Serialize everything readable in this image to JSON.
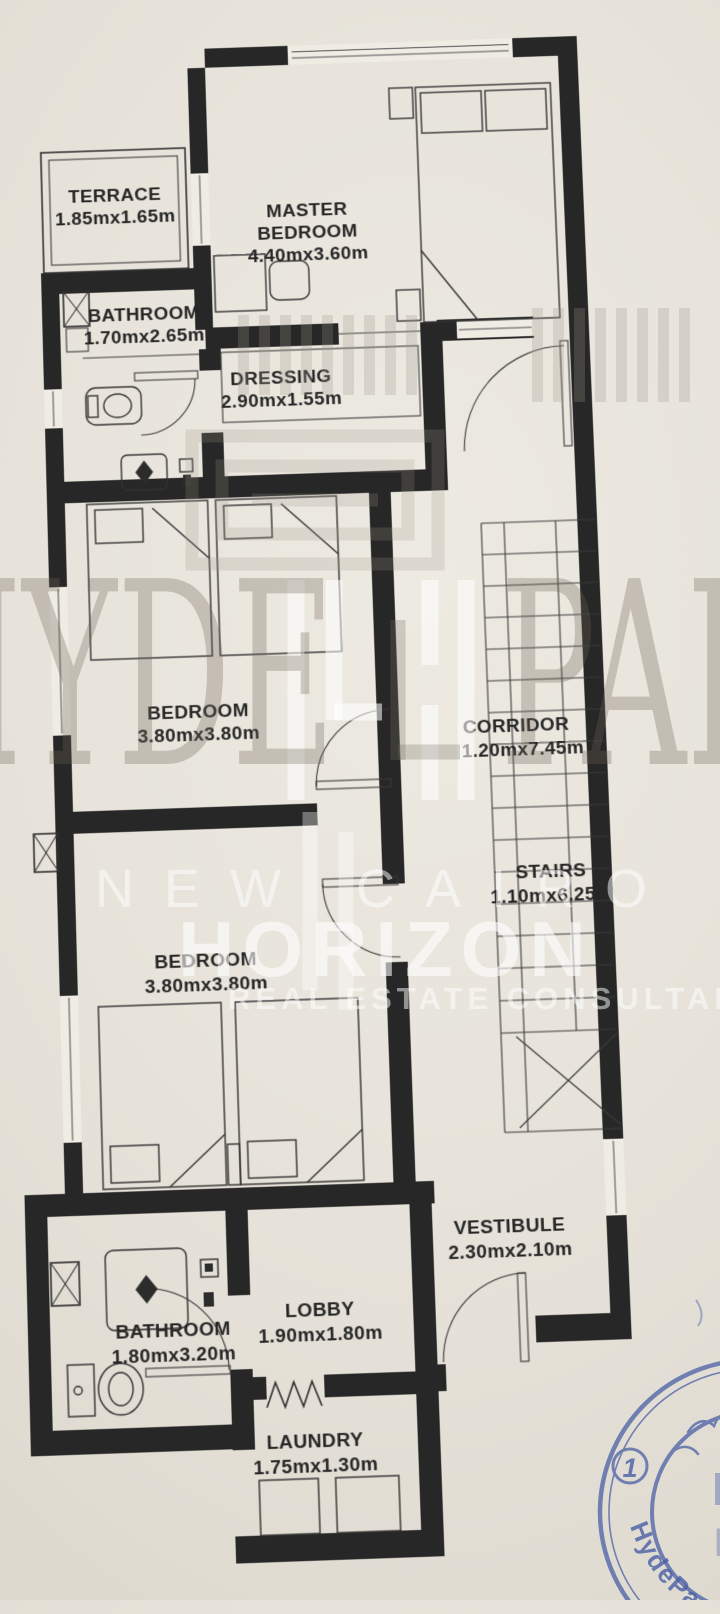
{
  "colors": {
    "paper": "#e6e2d9",
    "ink": "#272727",
    "stamp_blue": "#4a5fa5"
  },
  "rooms": [
    {
      "id": "terrace",
      "label_lines": [
        "TERRACE"
      ],
      "dims": "1.85mx1.65m"
    },
    {
      "id": "master-bedroom",
      "label_lines": [
        "MASTER",
        "BEDROOM"
      ],
      "dims": "4.40mx3.60m"
    },
    {
      "id": "bathroom-top",
      "label_lines": [
        "BATHROOM"
      ],
      "dims": "1.70mx2.65m"
    },
    {
      "id": "dressing",
      "label_lines": [
        "DRESSING"
      ],
      "dims": "2.90mx1.55m"
    },
    {
      "id": "bedroom-middle",
      "label_lines": [
        "BEDROOM"
      ],
      "dims": "3.80mx3.80m"
    },
    {
      "id": "corridor",
      "label_lines": [
        "CORRIDOR"
      ],
      "dims": "1.20mx7.45m"
    },
    {
      "id": "stairs",
      "label_lines": [
        "STAIRS"
      ],
      "dims": "1.10mx6.25m"
    },
    {
      "id": "bedroom-lower",
      "label_lines": [
        "BEDROOM"
      ],
      "dims": "3.80mx3.80m"
    },
    {
      "id": "vestibule",
      "label_lines": [
        "VESTIBULE"
      ],
      "dims": "2.30mx2.10m"
    },
    {
      "id": "bathroom-bottom",
      "label_lines": [
        "BATHROOM"
      ],
      "dims": "1.80mx3.20m"
    },
    {
      "id": "lobby",
      "label_lines": [
        "LOBBY"
      ],
      "dims": "1.90mx1.80m"
    },
    {
      "id": "laundry",
      "label_lines": [
        "LAUNDRY"
      ],
      "dims": "1.75mx1.30m"
    }
  ],
  "watermark": {
    "brand_left": "HYDE",
    "brand_right": "PARK",
    "subtitle": "NEW CAIRO",
    "agency": "HORIZON",
    "tagline": "REAL ESTATE CONSULTANCY"
  },
  "stamp": {
    "brand": "HydePark",
    "number": "1",
    "monogram": "HY"
  }
}
